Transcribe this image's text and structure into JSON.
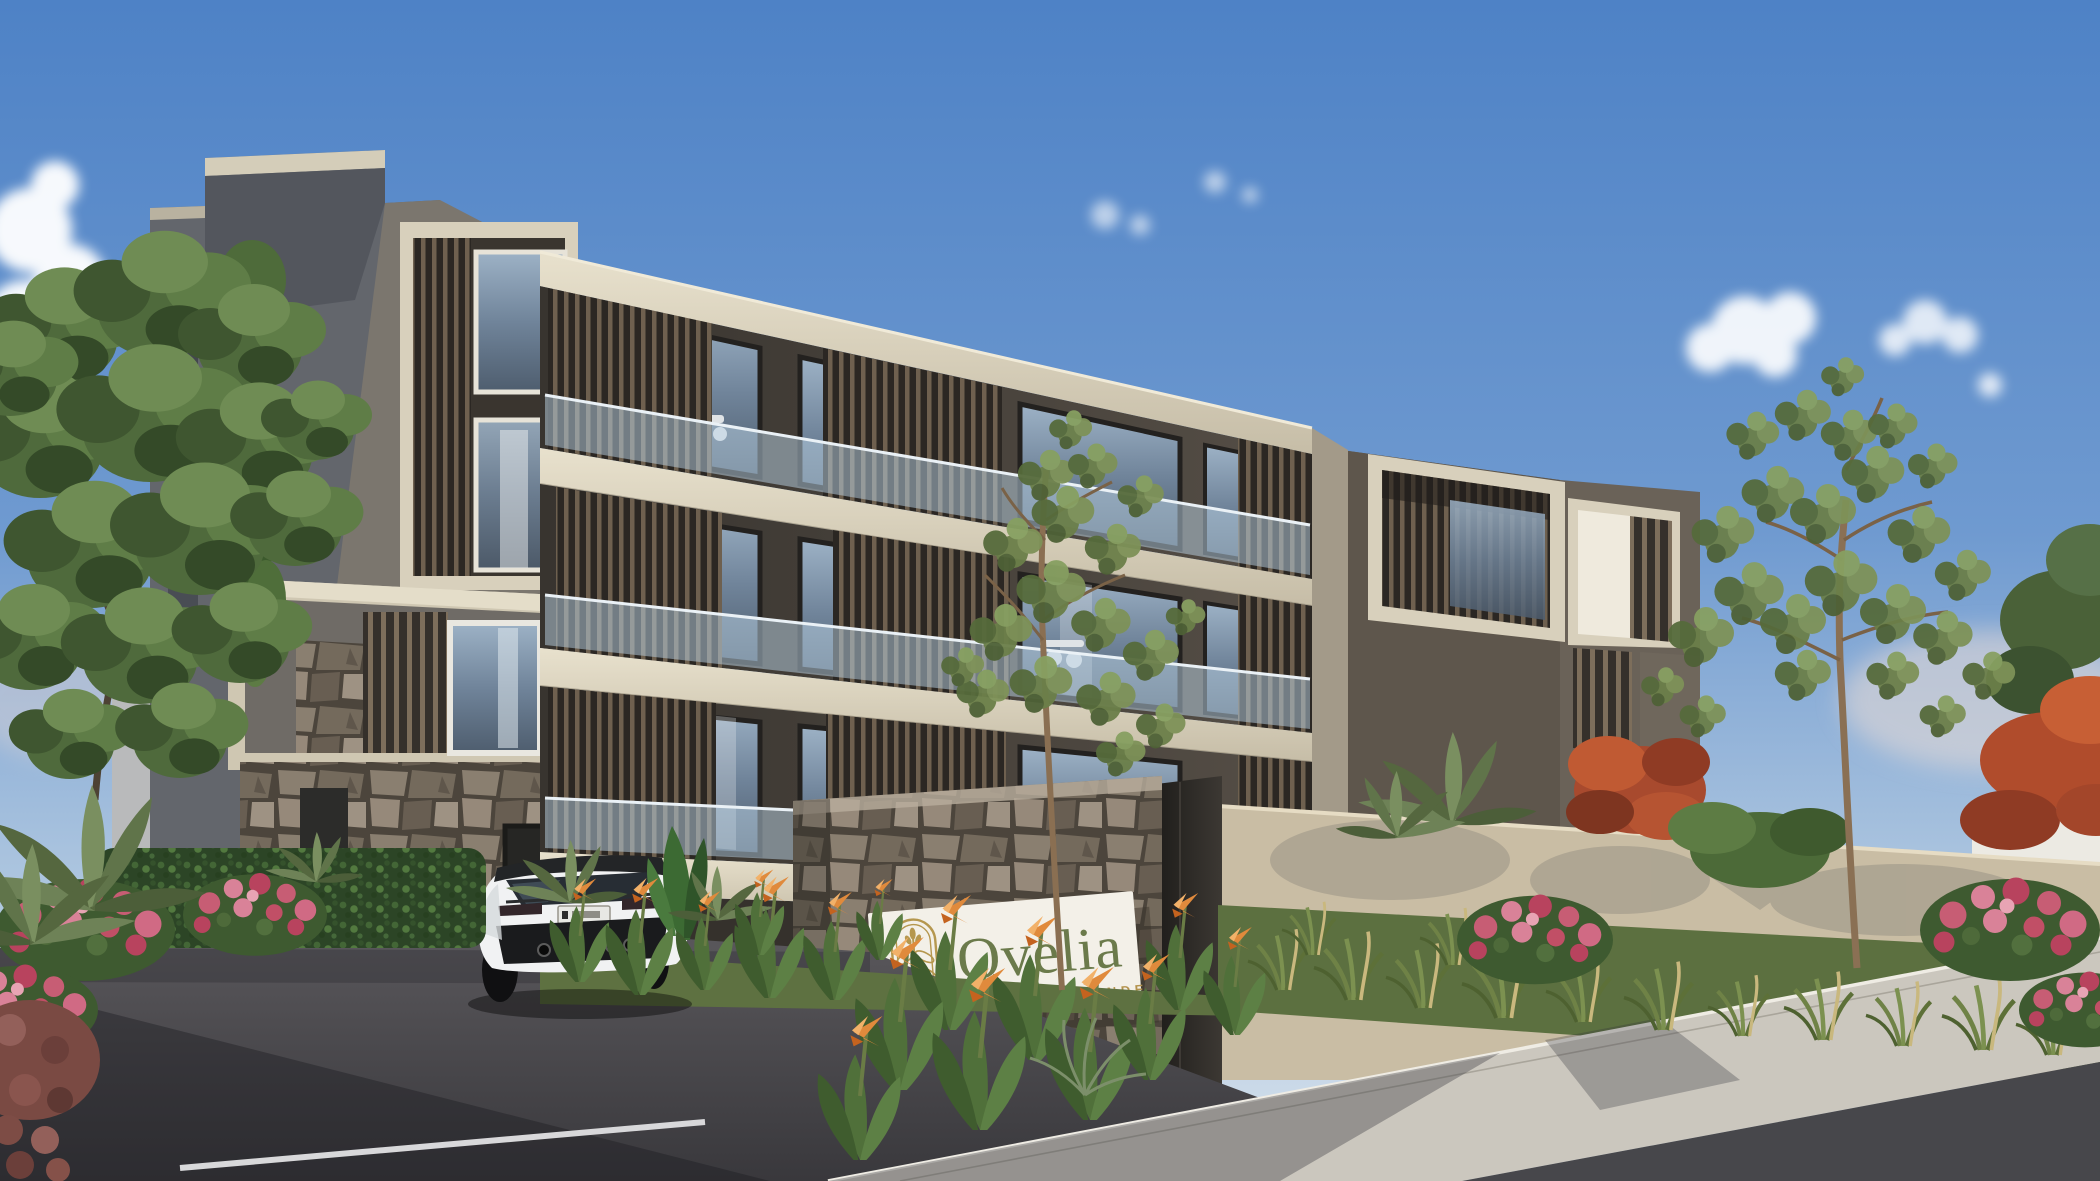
{
  "sign": {
    "brand": "Ovelia",
    "tagline": "AU BOUT DU MONDE",
    "logo_icon": "wheat-arch-emblem",
    "brand_color": "#6b7a4b",
    "tagline_color": "#b3924c",
    "logo_color": "#b5974e",
    "panel_color": "#f3f0e8"
  },
  "scene": {
    "subject": "modern apartment residence exterior with entrance sign, white coupe car, stone walls and tropical landscaping",
    "palette": {
      "sky_top": "#4e82c6",
      "sky_horizon": "#d7e2ec",
      "facade_cream": "#d9d2bf",
      "slat_brown": "#6e604f",
      "balcony_interior": "#3b3734",
      "glass_blue": "#8aa0b6",
      "stone_gray": "#8a7f70",
      "left_block_gray": "#63666c",
      "perimeter_wall_beige": "#c9bda4",
      "white_wall": "#eceae3",
      "asphalt": "#46464a",
      "sidewalk_concrete": "#cbc7be",
      "grass_green": "#5c7040",
      "flower_pink": "#c25269",
      "flower_orange": "#dd8440",
      "flamboyant_red": "#b84a30",
      "car_body": "#f1f2f3"
    }
  }
}
